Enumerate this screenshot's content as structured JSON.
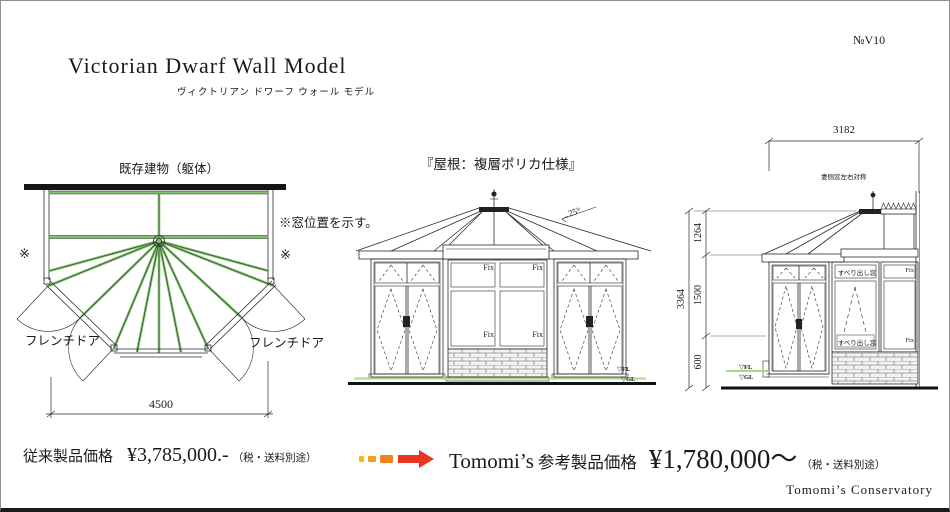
{
  "page": {
    "doc_no": "№V10",
    "title": "Victorian Dwarf Wall Model",
    "subtitle": "ヴィクトリアン ドワーフ ウォール モデル",
    "brand_credit": "Tomomi’s  Conservatory"
  },
  "plan": {
    "existing_building": "既存建物（躯体）",
    "window_note": "※窓位置を示す。",
    "asterisk_left": "※",
    "asterisk_right": "※",
    "french_door_left": "フレンチドア",
    "french_door_right": "フレンチドア",
    "width_dim": "4500"
  },
  "front": {
    "roof_spec": "『屋根：複層ポリカ仕様』",
    "roof_angle": "25°",
    "fix_top_left": "Fix",
    "fix_top_right": "Fix",
    "fix_bottom_left": "Fix",
    "fix_bottom_right": "Fix",
    "fl_marker": "▽FL",
    "gl_marker": "▽GL"
  },
  "side": {
    "width_dim": "3182",
    "note": "妻側窓左右対称",
    "dim_total": "3364",
    "dim_roof": "1264",
    "dim_window": "1500",
    "dim_wall": "600",
    "awning_label_top": "すべり出し窓",
    "awning_label_bottom": "すべり出し窓",
    "fix_top": "Fix",
    "fix_bottom": "Fix",
    "fl_marker": "▽FL",
    "gl_marker": "▽GL"
  },
  "pricing": {
    "old_label": "従来製品価格",
    "old_price": "¥3,785,000.-",
    "old_tax_note": "（税・送料別途）",
    "new_brand": "Tomomi’s",
    "new_label": "参考製品価格",
    "new_price": "¥1,780,000〜",
    "new_tax_note": "（税・送料別途）"
  },
  "colors": {
    "frame_green": "#7cc46a",
    "fl_line_green": "#a6d98c",
    "arrow_start": "#f9b913",
    "arrow_end": "#e93323"
  }
}
